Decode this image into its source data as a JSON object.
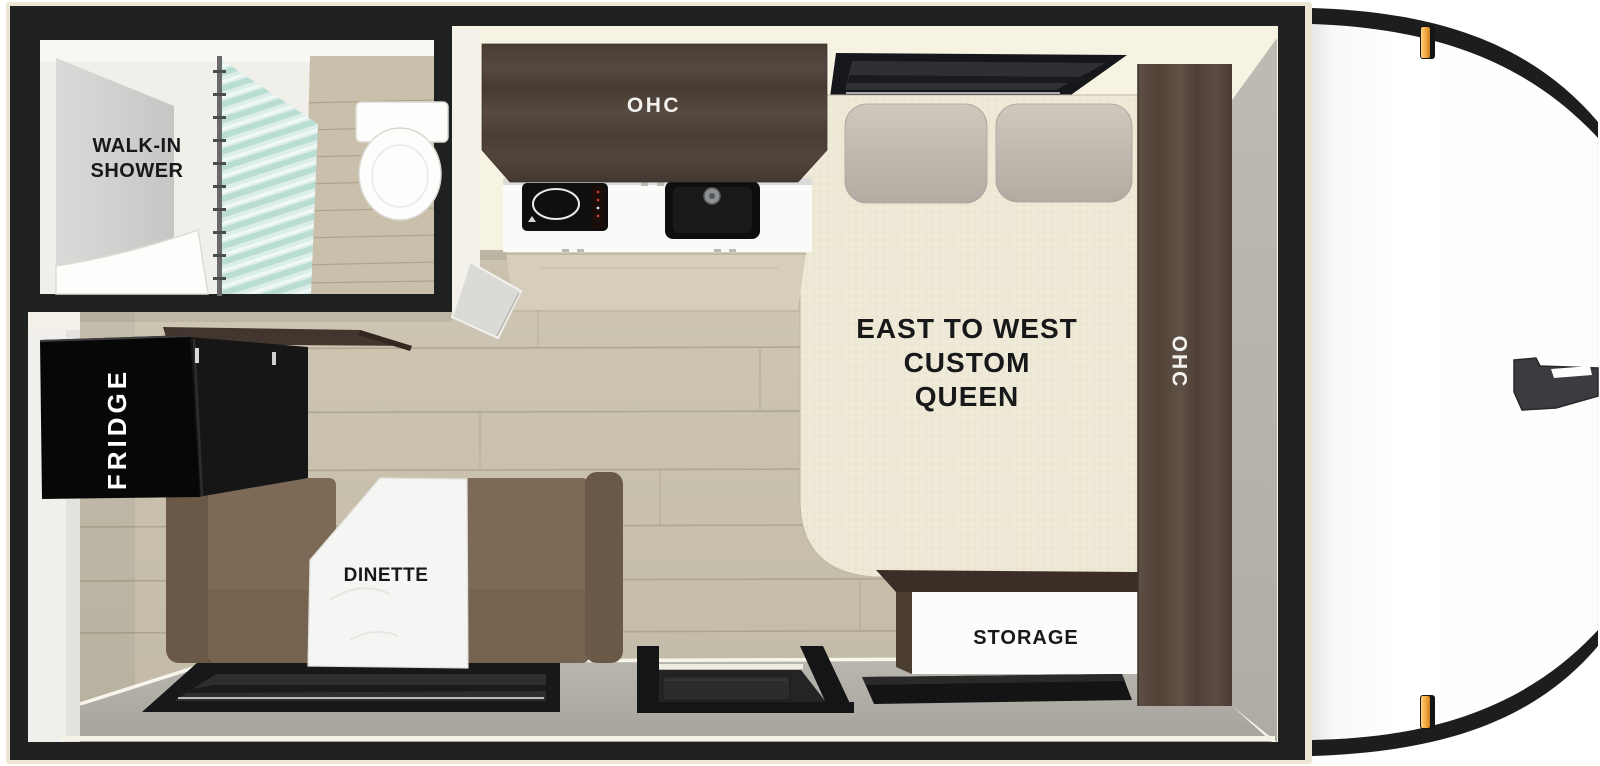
{
  "floorplan": {
    "bathroom": {
      "shower_label_line1": "WALK-IN",
      "shower_label_line2": "SHOWER"
    },
    "kitchen": {
      "overhead_cabinet_label": "OHC"
    },
    "bedroom": {
      "bed_label_line1": "EAST TO WEST",
      "bed_label_line2": "CUSTOM",
      "bed_label_line3": "QUEEN",
      "side_cabinet_label": "OHC",
      "storage_label": "STORAGE"
    },
    "galley": {
      "fridge_label": "FRIDGE",
      "dinette_label": "DINETTE"
    },
    "colors": {
      "wall_black": "#202121",
      "outline_cream": "#ece6d2",
      "interior_cream": "#f7f3e3",
      "floor_wood": "#c9c1ae",
      "bottom_wall_gray": "#b1afa7",
      "cabinet_wood": "#4d4037",
      "bed_cream": "#eee8d5",
      "pillow_gray": "#c6beb5",
      "bench_brown": "#7d6a56",
      "table_white": "#f5f5f3",
      "curtain_mint": "#cfe9e2",
      "appliance_black": "#111213",
      "marker_light_amber": "#f0a43c",
      "hitch_gray": "#3b3b40"
    }
  }
}
